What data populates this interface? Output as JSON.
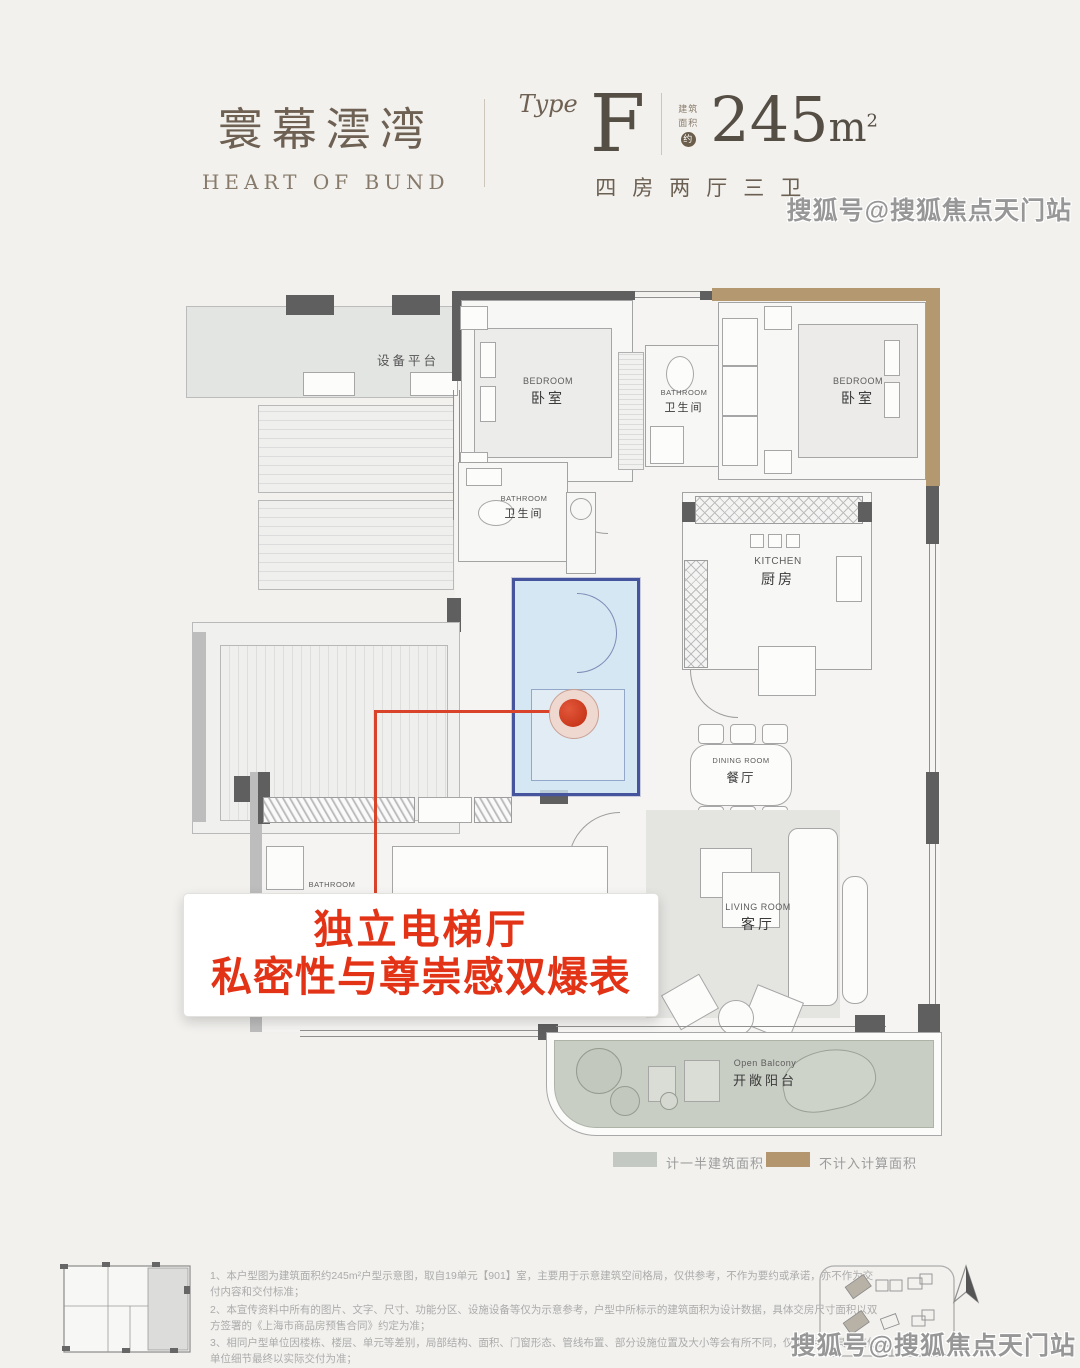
{
  "header": {
    "brand_cn": "寰幕澐湾",
    "brand_en": "HEART OF BUND",
    "type_label": "Type",
    "type_value": "F",
    "area_prefix_1": "建筑",
    "area_prefix_2": "面积",
    "area_circle": "约",
    "area_value": "245",
    "area_unit": "m",
    "area_unit_sup": "2",
    "layout_desc": "四房两厅三卫"
  },
  "watermark": {
    "text": "搜狐号@搜狐焦点天门站"
  },
  "floorplan": {
    "equipment_platform": "设备平台",
    "rooms": [
      {
        "en": "BEDROOM",
        "cn": "卧室"
      },
      {
        "en": "BATHROOM",
        "cn": "卫生间"
      },
      {
        "en": "BEDROOM",
        "cn": "卧室"
      },
      {
        "en": "BATHROOM",
        "cn": "卫生间"
      },
      {
        "en": "KITCHEN",
        "cn": "厨房"
      },
      {
        "en": "DINING ROOM",
        "cn": "餐厅"
      },
      {
        "en": "LIVING ROOM",
        "cn": "客厅"
      },
      {
        "en": "BATHROOM",
        "cn": ""
      },
      {
        "en": "Open Balcony",
        "cn": "开敞阳台"
      }
    ]
  },
  "callout": {
    "line1": "独立电梯厅",
    "line2": "私密性与尊崇感双爆表",
    "accent_color": "#e23317"
  },
  "legend": [
    {
      "label": "计一半建筑面积",
      "color": "#c3c8c3"
    },
    {
      "label": "不计入计算面积",
      "color": "#b4966e"
    }
  ],
  "highlight": {
    "fill": "#cee4f3",
    "border": "#46549e"
  },
  "disclaimer": [
    "1、本户型图为建筑面积约245m²户型示意图，取自19单元【901】室，主要用于示意建筑空间格局，仅供参考，不作为要约或承诺，亦不作为交付内容和交付标准；",
    "2、本宣传资料中所有的图片、文字、尺寸、功能分区、设施设备等仅为示意参考，户型中所标示的建筑面积为设计数据，具体交房尺寸面积以双方签署的《上海市商品房预售合同》约定为准；",
    "3、相同户型单位因楼栋、楼层、单元等差别，局部结构、面积、门窗形态、管线布置、部分设施位置及大小等会有所不同，仅供参考，具体交付单位细节最终以实际交付为准；",
    "4、本项目备案名为“瑞耀名庭”、推广名为“澐启滨江”，开发商为：上海新舞坊企业发展有限公司，本户型图仅供参考，不作为要约邀请，相关内容不排除因政府相关规划、规定及开发商未能知晓的原因而发生变化，本公司保留对宣传资料修改的权利，敬请留意最新资料。本户型图制作时间为2025年10月。"
  ]
}
